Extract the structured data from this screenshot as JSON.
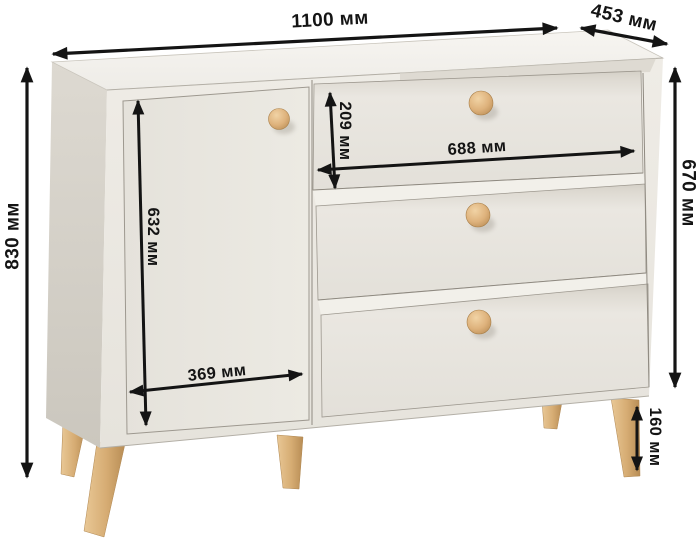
{
  "diagram": {
    "object_name": "chest-of-drawers-with-door",
    "unit": "мм",
    "labels": {
      "total_width": "1100 мм",
      "depth": "453 мм",
      "total_height": "830 мм",
      "body_height": "670 мм",
      "door_height": "632 мм",
      "door_width": "369 мм",
      "drawer_width": "688 мм",
      "drawer_height": "209 мм",
      "leg_height": "160 мм"
    },
    "dimensions_mm": {
      "total_width": 1100,
      "depth": 453,
      "total_height": 830,
      "body_height": 670,
      "door_height": 632,
      "door_width": 369,
      "drawer_width": 688,
      "drawer_height": 209,
      "leg_height": 160
    },
    "colors": {
      "background": "#ffffff",
      "dimension_ink": "#141414",
      "body_front": "#ebe8e2",
      "body_top": "#f4f2ee",
      "body_side": "#d7d3ca",
      "wood_accent": "#d9ae76"
    }
  }
}
